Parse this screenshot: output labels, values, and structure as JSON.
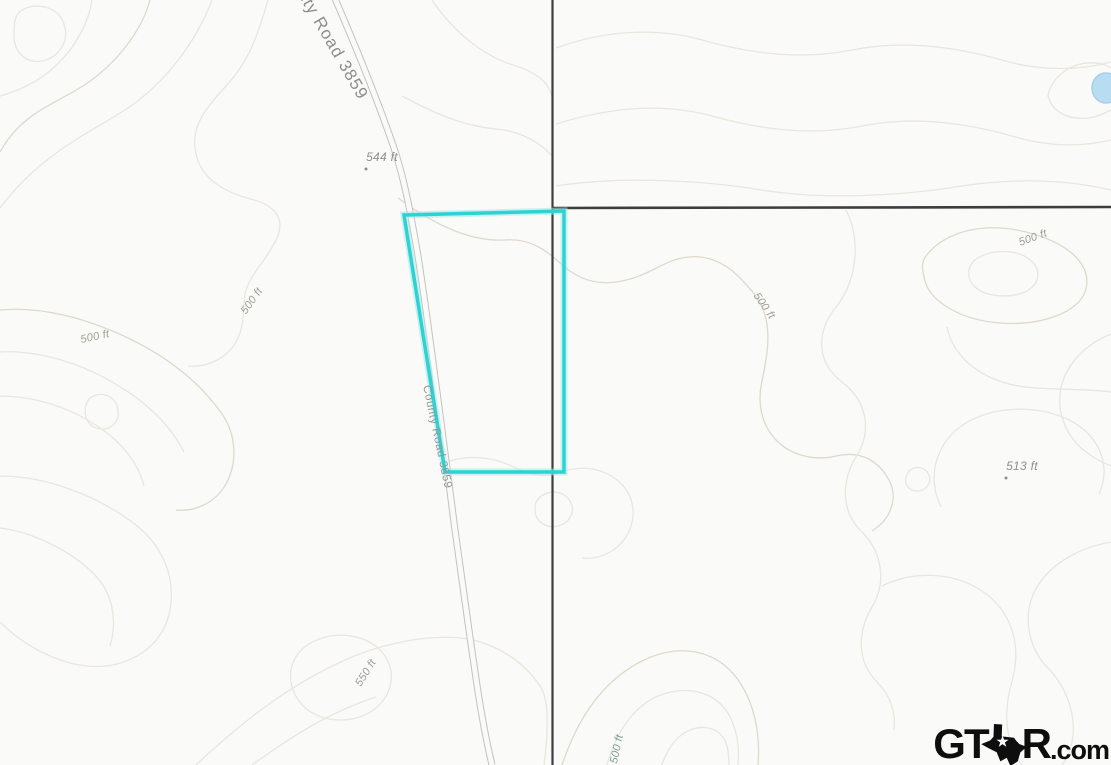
{
  "map": {
    "road_labels": {
      "top": "County Road 3859",
      "middle": "County Road 3859"
    },
    "contour_labels": {
      "west": "500 ft",
      "west_slope": "500 ft",
      "center_east": "500 ft",
      "northeast": "500 ft",
      "southwest_hill": "550 ft",
      "bottom_center": "500 ft"
    },
    "spot_elevations": {
      "northwest": "544 ft",
      "east": "513 ft"
    },
    "colors": {
      "background": "#fafaf8",
      "contour": "#e9e6de",
      "contour_index": "#ddd9cc",
      "road_casing": "#c4c2bf",
      "boundary_line": "#3d3d3d",
      "parcel_outline": "#2fd2d2",
      "water": "#b8dcf2"
    }
  },
  "watermark": {
    "gt": "GT",
    "r": "R",
    "com": ".com"
  }
}
